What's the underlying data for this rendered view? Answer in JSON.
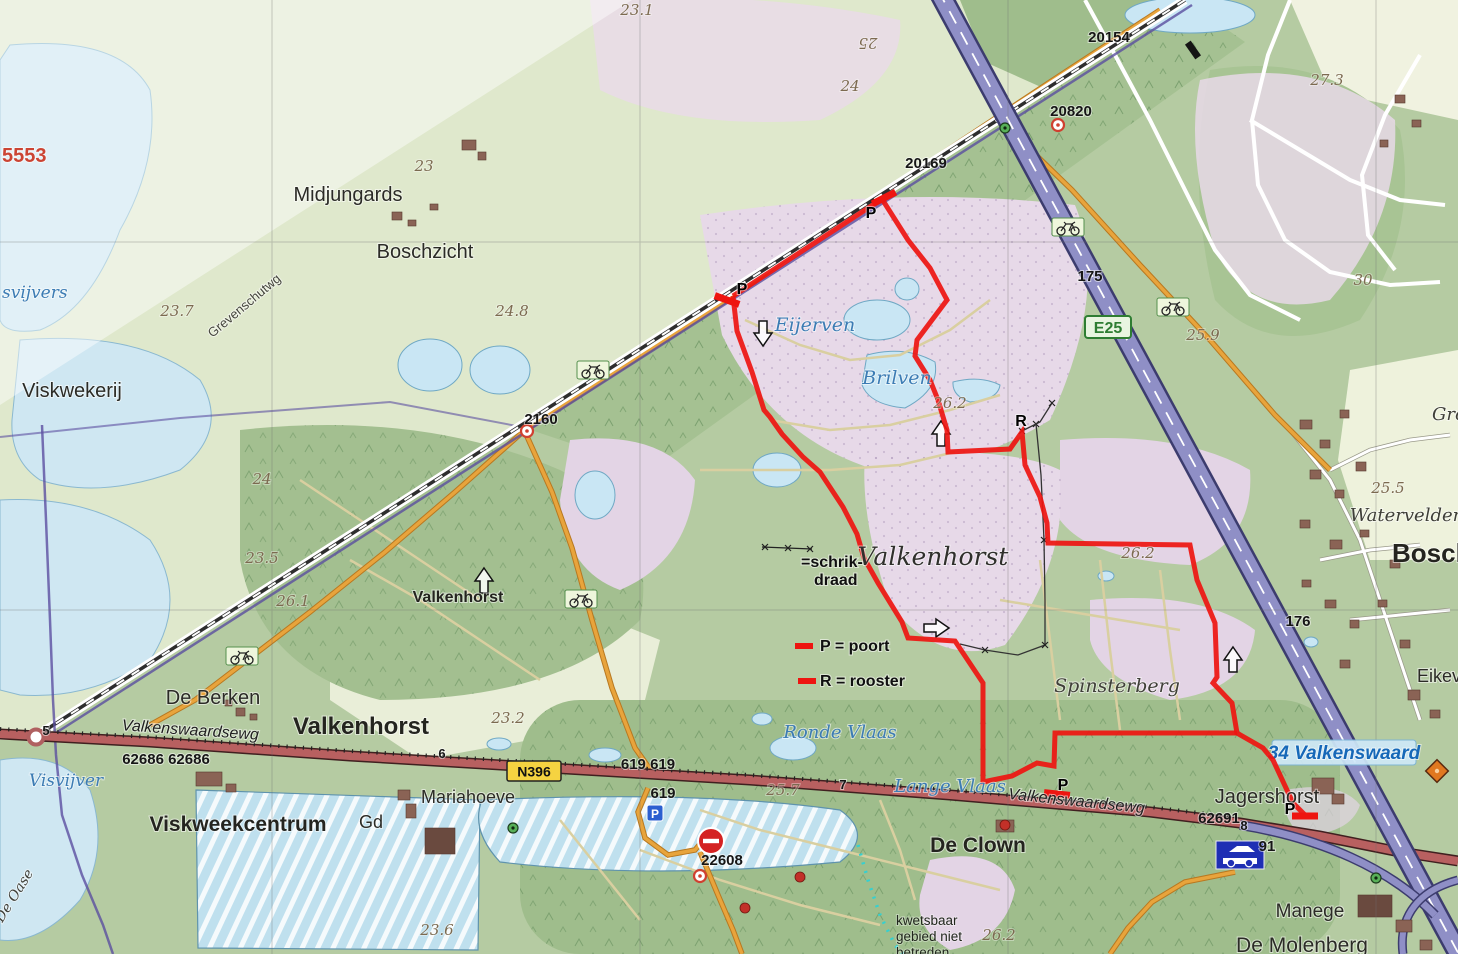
{
  "map": {
    "description": "Dutch topographic map of Valkenhorst / Valkenswaard area with red marked walking route",
    "route": {
      "color": "#ee1510",
      "width": 5,
      "segments": [
        [
          [
            882,
            199
          ],
          [
            733,
            296
          ]
        ],
        [
          [
            733,
            296
          ],
          [
            737,
            331
          ],
          [
            752,
            372
          ],
          [
            764,
            410
          ],
          [
            770,
            417
          ],
          [
            782,
            434
          ],
          [
            803,
            457
          ],
          [
            820,
            472
          ],
          [
            843,
            507
          ],
          [
            857,
            534
          ],
          [
            864,
            558
          ],
          [
            878,
            583
          ],
          [
            902,
            622
          ],
          [
            908,
            638
          ],
          [
            955,
            641
          ],
          [
            983,
            683
          ],
          [
            983,
            782
          ],
          [
            1012,
            776
          ],
          [
            1037,
            763
          ],
          [
            1054,
            766
          ],
          [
            1055,
            733
          ],
          [
            1237,
            733
          ]
        ],
        [
          [
            882,
            199
          ],
          [
            908,
            240
          ],
          [
            930,
            268
          ],
          [
            947,
            300
          ],
          [
            917,
            340
          ],
          [
            915,
            356
          ],
          [
            930,
            380
          ],
          [
            938,
            400
          ],
          [
            947,
            430
          ],
          [
            948,
            452
          ],
          [
            1010,
            449
          ],
          [
            1022,
            432
          ],
          [
            1025,
            465
          ],
          [
            1040,
            497
          ],
          [
            1047,
            523
          ],
          [
            1048,
            543
          ],
          [
            1190,
            545
          ],
          [
            1197,
            580
          ],
          [
            1215,
            623
          ],
          [
            1217,
            677
          ],
          [
            1213,
            683
          ],
          [
            1232,
            703
          ],
          [
            1237,
            733
          ],
          [
            1263,
            748
          ],
          [
            1273,
            760
          ],
          [
            1293,
            803
          ],
          [
            1305,
            815
          ]
        ]
      ],
      "gates": [
        {
          "x": 884,
          "y": 198,
          "rot": -27
        },
        {
          "x": 727,
          "y": 300,
          "rot": 20
        },
        {
          "x": 1057,
          "y": 794,
          "rot": 6
        },
        {
          "x": 1305,
          "y": 816,
          "rot": 0
        }
      ]
    },
    "legend": {
      "schrikdraad_lines": [
        "=schrik-",
        "draad"
      ],
      "poort": "P = poort",
      "rooster": "R = rooster"
    },
    "warning_lines": [
      "kwetsbaar",
      "gebied niet",
      "betreden"
    ],
    "fences": [
      {
        "pts": [
          [
            1036,
            424
          ],
          [
            1041,
            475
          ],
          [
            1044,
            540
          ],
          [
            1045,
            600
          ],
          [
            1045,
            645
          ],
          [
            1018,
            655
          ],
          [
            985,
            650
          ],
          [
            960,
            644
          ]
        ]
      },
      {
        "pts": [
          [
            1022,
            431
          ],
          [
            1040,
            422
          ],
          [
            1052,
            403
          ]
        ]
      }
    ],
    "labels": [
      {
        "n": "midjungards",
        "t": "Midjungards",
        "x": 348,
        "y": 201,
        "c": "lbl-town",
        "s": 20
      },
      {
        "n": "boschzicht",
        "t": "Boschzicht",
        "x": 425,
        "y": 258,
        "c": "lbl-town",
        "s": 20
      },
      {
        "n": "viskwekerij",
        "t": "Viskwekerij",
        "x": 72,
        "y": 397,
        "c": "lbl-town",
        "s": 20
      },
      {
        "n": "de-berken",
        "t": "De Berken",
        "x": 213,
        "y": 704,
        "c": "lbl-town",
        "s": 20
      },
      {
        "n": "valkenhorst-town",
        "t": "Valkenhorst",
        "x": 361,
        "y": 734,
        "c": "lbl-town-b",
        "s": 24
      },
      {
        "n": "viskweekcentrum",
        "t": "Viskweekcentrum",
        "x": 238,
        "y": 831,
        "c": "lbl-town-b",
        "s": 21
      },
      {
        "n": "gd",
        "t": "Gd",
        "x": 371,
        "y": 828,
        "c": "lbl-town",
        "s": 18
      },
      {
        "n": "mariahoeve",
        "t": "Mariahoeve",
        "x": 468,
        "y": 803,
        "c": "lbl-town",
        "s": 18
      },
      {
        "n": "de-clown",
        "t": "De Clown",
        "x": 978,
        "y": 852,
        "c": "lbl-town-b",
        "s": 21
      },
      {
        "n": "jagershorst",
        "t": "Jagershorst",
        "x": 1267,
        "y": 803,
        "c": "lbl-town",
        "s": 20
      },
      {
        "n": "manege",
        "t": "Manege",
        "x": 1310,
        "y": 917,
        "c": "lbl-town",
        "s": 19
      },
      {
        "n": "de-molenberg",
        "t": "De Molenberg",
        "x": 1302,
        "y": 952,
        "c": "lbl-town",
        "s": 21
      },
      {
        "n": "valkenhorst-small",
        "t": "Valkenhorst",
        "x": 458,
        "y": 602,
        "c": "lbl-town-b",
        "s": 16
      },
      {
        "n": "bosch-cut",
        "t": "Bosch",
        "x": 1392,
        "y": 562,
        "c": "lbl-town-b",
        "s": 26,
        "a": "start"
      },
      {
        "n": "eikeve-cut",
        "t": "Eikeve",
        "x": 1417,
        "y": 682,
        "c": "lbl-town",
        "s": 18,
        "a": "start"
      },
      {
        "n": "valkenhorst-big",
        "t": "Valkenhorst",
        "x": 933,
        "y": 565,
        "c": "lbl-big",
        "s": 25
      },
      {
        "n": "eijerven",
        "t": "Eijerven",
        "x": 815,
        "y": 331,
        "c": "lbl-water",
        "s": 19
      },
      {
        "n": "brilven",
        "t": "Brilven",
        "x": 897,
        "y": 384,
        "c": "lbl-water",
        "s": 19
      },
      {
        "n": "ronde-vlaas",
        "t": "Ronde Vlaas",
        "x": 840,
        "y": 738,
        "c": "lbl-water",
        "s": 18
      },
      {
        "n": "lange-vlaas",
        "t": "Lange Vlaas",
        "x": 950,
        "y": 792,
        "c": "lbl-water",
        "s": 18
      },
      {
        "n": "visvijver",
        "t": "Visvijver",
        "x": 66,
        "y": 786,
        "c": "lbl-water",
        "s": 17
      },
      {
        "n": "svijvers-cut",
        "t": "svijvers",
        "x": 2,
        "y": 298,
        "c": "lbl-water",
        "s": 17,
        "a": "start"
      },
      {
        "n": "de-oase",
        "t": "De Oase",
        "x": 18,
        "y": 898,
        "c": "lbl-area",
        "s": 14,
        "r": -58
      },
      {
        "n": "spinsterberg",
        "t": "Spinsterberg",
        "x": 1117,
        "y": 692,
        "c": "lbl-area",
        "s": 19
      },
      {
        "n": "watervelden",
        "t": "Watervelden",
        "x": 1407,
        "y": 521,
        "c": "lbl-area",
        "s": 18
      },
      {
        "n": "gro-cut",
        "t": "Gro",
        "x": 1432,
        "y": 420,
        "c": "lbl-area",
        "s": 18,
        "a": "start"
      },
      {
        "n": "grevenschutwg",
        "t": "Grevenschutwg",
        "x": 247,
        "y": 309,
        "c": "lbl-grev",
        "s": 13,
        "r": -40
      },
      {
        "n": "valkenswaardsewg-w",
        "t": "Valkenswaardsewg",
        "x": 190,
        "y": 735,
        "c": "lbl-road",
        "s": 16,
        "r": 4
      },
      {
        "n": "valkenswaardsewg-e",
        "t": "Valkenswaardsewg",
        "x": 1076,
        "y": 806,
        "c": "lbl-road",
        "s": 16,
        "r": 6
      },
      {
        "n": "c23-1",
        "t": "23.1",
        "x": 637,
        "y": 15,
        "c": "lbl-contour",
        "s": 15
      },
      {
        "n": "c25",
        "t": "25",
        "x": 868,
        "y": 38,
        "c": "lbl-contour",
        "s": 15,
        "r": 180
      },
      {
        "n": "c24a",
        "t": "24",
        "x": 850,
        "y": 91,
        "c": "lbl-contour",
        "s": 15
      },
      {
        "n": "c23",
        "t": "23",
        "x": 424,
        "y": 171,
        "c": "lbl-contour",
        "s": 15
      },
      {
        "n": "c24-8",
        "t": "24.8",
        "x": 512,
        "y": 316,
        "c": "lbl-contour",
        "s": 15
      },
      {
        "n": "c23-7",
        "t": "23.7",
        "x": 177,
        "y": 316,
        "c": "lbl-contour",
        "s": 15
      },
      {
        "n": "c24b",
        "t": "24",
        "x": 262,
        "y": 484,
        "c": "lbl-contour",
        "s": 15
      },
      {
        "n": "c23-5",
        "t": "23.5",
        "x": 262,
        "y": 563,
        "c": "lbl-contour",
        "s": 15
      },
      {
        "n": "c26-1",
        "t": "26.1",
        "x": 293,
        "y": 606,
        "c": "lbl-contour",
        "s": 15
      },
      {
        "n": "c23-2",
        "t": "23.2",
        "x": 508,
        "y": 723,
        "c": "lbl-contour",
        "s": 15
      },
      {
        "n": "c25-7",
        "t": "25.7",
        "x": 783,
        "y": 795,
        "c": "lbl-contour",
        "s": 15
      },
      {
        "n": "c23-6",
        "t": "23.6",
        "x": 437,
        "y": 935,
        "c": "lbl-contour",
        "s": 15
      },
      {
        "n": "c26-2a",
        "t": "26.2",
        "x": 950,
        "y": 408,
        "c": "lbl-contour",
        "s": 15
      },
      {
        "n": "c26-2b",
        "t": "26.2",
        "x": 1138,
        "y": 558,
        "c": "lbl-contour",
        "s": 15
      },
      {
        "n": "c26-2c",
        "t": "26.2",
        "x": 999,
        "y": 940,
        "c": "lbl-contour",
        "s": 15
      },
      {
        "n": "c27-3",
        "t": "27.3",
        "x": 1327,
        "y": 85,
        "c": "lbl-contour",
        "s": 15
      },
      {
        "n": "c25-9",
        "t": "25.9",
        "x": 1203,
        "y": 340,
        "c": "lbl-contour",
        "s": 15
      },
      {
        "n": "c30",
        "t": "30",
        "x": 1363,
        "y": 285,
        "c": "lbl-contour",
        "s": 15
      },
      {
        "n": "c25-5",
        "t": "25.5",
        "x": 1388,
        "y": 493,
        "c": "lbl-contour",
        "s": 15
      },
      {
        "n": "hm20154",
        "t": "20154",
        "x": 1109,
        "y": 42,
        "c": "lbl-hm",
        "s": 15
      },
      {
        "n": "hm20820",
        "t": "20820",
        "x": 1071,
        "y": 116,
        "c": "lbl-hm",
        "s": 15
      },
      {
        "n": "hm20169",
        "t": "20169",
        "x": 926,
        "y": 168,
        "c": "lbl-hm",
        "s": 15
      },
      {
        "n": "hm2160",
        "t": "2160",
        "x": 541,
        "y": 424,
        "c": "lbl-hm",
        "s": 15
      },
      {
        "n": "hm175",
        "t": "175",
        "x": 1090,
        "y": 281,
        "c": "lbl-hm",
        "s": 15
      },
      {
        "n": "hm176",
        "t": "176",
        "x": 1298,
        "y": 626,
        "c": "lbl-hm",
        "s": 15
      },
      {
        "n": "hm62686",
        "t": "62686  62686",
        "x": 166,
        "y": 764,
        "c": "lbl-hm",
        "s": 15
      },
      {
        "n": "hm619-619",
        "t": "619  619",
        "x": 648,
        "y": 769,
        "c": "lbl-hm",
        "s": 15
      },
      {
        "n": "hm619",
        "t": "619",
        "x": 663,
        "y": 798,
        "c": "lbl-hm",
        "s": 15
      },
      {
        "n": "hm22608",
        "t": "22608",
        "x": 722,
        "y": 865,
        "c": "lbl-hm",
        "s": 15
      },
      {
        "n": "hm62691",
        "t": "62691",
        "x": 1219,
        "y": 823,
        "c": "lbl-hm",
        "s": 15
      },
      {
        "n": "hm91",
        "t": "91",
        "x": 1267,
        "y": 851,
        "c": "lbl-hm",
        "s": 15
      },
      {
        "n": "km5",
        "t": "5",
        "x": 46,
        "y": 735,
        "c": "lbl-hm",
        "s": 13
      },
      {
        "n": "km6",
        "t": "6",
        "x": 442,
        "y": 758,
        "c": "lbl-hm",
        "s": 13
      },
      {
        "n": "km7",
        "t": "7",
        "x": 843,
        "y": 789,
        "c": "lbl-hm",
        "s": 13
      },
      {
        "n": "km8",
        "t": "8",
        "x": 1244,
        "y": 830,
        "c": "lbl-hm",
        "s": 13
      },
      {
        "n": "red5553",
        "t": "5553",
        "x": 2,
        "y": 162,
        "c": "lbl-red",
        "s": 20,
        "a": "start"
      },
      {
        "n": "gate-p1",
        "t": "P",
        "x": 871,
        "y": 218,
        "c": "lbl-pr",
        "s": 16
      },
      {
        "n": "gate-p2",
        "t": "P",
        "x": 742,
        "y": 294,
        "c": "lbl-pr",
        "s": 16
      },
      {
        "n": "gate-p3",
        "t": "P",
        "x": 1063,
        "y": 790,
        "c": "lbl-pr",
        "s": 16
      },
      {
        "n": "gate-p4",
        "t": "P",
        "x": 1290,
        "y": 814,
        "c": "lbl-pr",
        "s": 16
      },
      {
        "n": "rooster-r",
        "t": "R",
        "x": 1021,
        "y": 426,
        "c": "lbl-pr",
        "s": 16
      }
    ],
    "icons": [
      {
        "t": "bike",
        "n": "bicycle-icon",
        "x": 1068,
        "y": 227
      },
      {
        "t": "bike",
        "n": "bicycle-icon",
        "x": 1173,
        "y": 307
      },
      {
        "t": "bike",
        "n": "bicycle-icon",
        "x": 593,
        "y": 370
      },
      {
        "t": "bike",
        "n": "bicycle-icon",
        "x": 581,
        "y": 599
      },
      {
        "t": "bike",
        "n": "bicycle-icon",
        "x": 242,
        "y": 656
      },
      {
        "t": "arrow",
        "n": "route-arrow-down-icon",
        "x": 763,
        "y": 333,
        "dir": "down"
      },
      {
        "t": "arrow",
        "n": "route-arrow-up-icon",
        "x": 941,
        "y": 434,
        "dir": "up"
      },
      {
        "t": "arrow",
        "n": "route-arrow-right-icon",
        "x": 936,
        "y": 628,
        "dir": "right"
      },
      {
        "t": "arrow",
        "n": "route-arrow-up-icon",
        "x": 484,
        "y": 581,
        "dir": "up"
      },
      {
        "t": "arrow",
        "n": "route-arrow-up-icon",
        "x": 1233,
        "y": 660,
        "dir": "up"
      },
      {
        "t": "parking",
        "n": "parking-icon",
        "x": 655,
        "y": 813,
        "label": "P"
      },
      {
        "t": "carsign",
        "n": "car-sign-icon",
        "x": 1240,
        "y": 855
      },
      {
        "t": "noentry",
        "n": "no-entry-icon",
        "x": 711,
        "y": 841
      },
      {
        "t": "greendot",
        "n": "crossing-icon",
        "x": 1005,
        "y": 128
      },
      {
        "t": "greendot",
        "n": "crossing-icon",
        "x": 513,
        "y": 828
      },
      {
        "t": "greendot",
        "n": "crossing-icon",
        "x": 1376,
        "y": 878
      },
      {
        "t": "redring",
        "n": "poi-icon",
        "x": 1058,
        "y": 125
      },
      {
        "t": "redring",
        "n": "poi-icon",
        "x": 527,
        "y": 431
      },
      {
        "t": "redring",
        "n": "poi-icon",
        "x": 700,
        "y": 876
      },
      {
        "t": "reddot",
        "n": "poi-icon",
        "x": 800,
        "y": 877
      },
      {
        "t": "reddot",
        "n": "poi-icon",
        "x": 1005,
        "y": 825
      },
      {
        "t": "reddot",
        "n": "poi-icon",
        "x": 745,
        "y": 908
      },
      {
        "t": "diamond",
        "n": "campsite-icon",
        "x": 1437,
        "y": 771
      },
      {
        "t": "crossbar",
        "n": "railway-halt-icon",
        "x": 1193,
        "y": 50,
        "rot": -35
      },
      {
        "t": "roundabout",
        "n": "roundabout-icon",
        "x": 36,
        "y": 737
      },
      {
        "t": "badge-green",
        "n": "e-road-badge",
        "x": 1108,
        "y": 327,
        "label": "E25"
      },
      {
        "t": "badge-yellow",
        "n": "n-road-badge",
        "x": 534,
        "y": 771,
        "label": "N396"
      },
      {
        "t": "sign-exit",
        "n": "motorway-exit-sign",
        "x": 1344,
        "y": 753,
        "label": "34 Valkenswaard"
      }
    ]
  }
}
